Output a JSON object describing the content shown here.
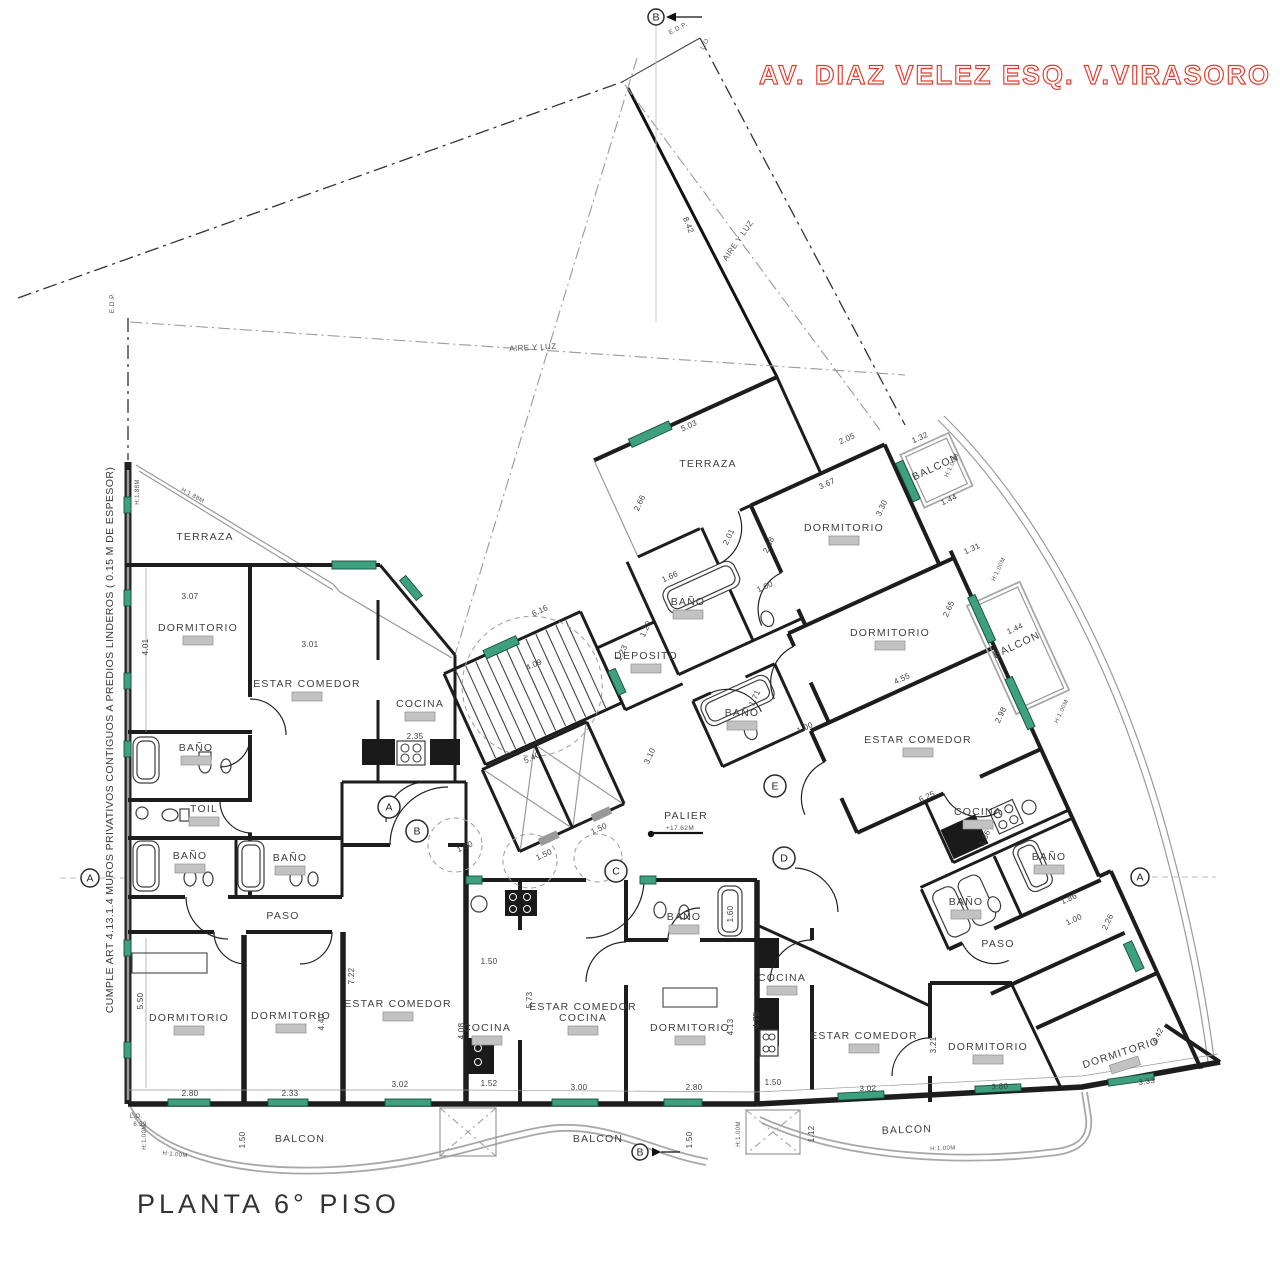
{
  "titles": {
    "street": "AV. DIAZ VELEZ ESQ. V.VIRASORO",
    "plan": "PLANTA 6° PISO",
    "compliance": "CUMPLE ART 4.13.1.4  MUROS PRIVATIVOS CONTIGUOS A PREDIOS LINDEROS ( 0.15 M DE ESPESOR)"
  },
  "colors": {
    "accent_red": "#e23b2c",
    "window_green": "#3fa080",
    "wall": "#1d1d1d",
    "gray": "#9a9a9a"
  },
  "plan": {
    "rooms": [
      {
        "t": "TERRAZA",
        "x": 205,
        "y": 540
      },
      {
        "t": "DORMITORIO",
        "x": 198,
        "y": 631,
        "tag": 1
      },
      {
        "t": "ESTAR COMEDOR",
        "x": 307,
        "y": 687,
        "tag": 1
      },
      {
        "t": "COCINA",
        "x": 420,
        "y": 707,
        "tag": 1
      },
      {
        "t": "BAÑO",
        "x": 196,
        "y": 751,
        "tag": 1
      },
      {
        "t": "TOIL",
        "x": 204,
        "y": 812,
        "tag": 1
      },
      {
        "t": "BAÑO",
        "x": 190,
        "y": 859,
        "tag": 1
      },
      {
        "t": "BAÑO",
        "x": 290,
        "y": 861,
        "tag": 1
      },
      {
        "t": "PASO",
        "x": 283,
        "y": 919
      },
      {
        "t": "DORMITORIO",
        "x": 189,
        "y": 1021,
        "tag": 1
      },
      {
        "t": "DORMITORIO",
        "x": 291,
        "y": 1019,
        "tag": 1
      },
      {
        "t": "ESTAR COMEDOR",
        "x": 398,
        "y": 1007,
        "tag": 1
      },
      {
        "t": "COCINA",
        "x": 487,
        "y": 1031,
        "tag": 1
      },
      {
        "t": "ESTAR COMEDOR|COCINA",
        "x": 583,
        "y": 1010,
        "tag": 1
      },
      {
        "t": "BAÑO",
        "x": 684,
        "y": 920,
        "tag": 1
      },
      {
        "t": "DORMITORIO",
        "x": 690,
        "y": 1031,
        "tag": 1
      },
      {
        "t": "COCINA",
        "x": 782,
        "y": 981,
        "tag": 1
      },
      {
        "t": "ESTAR COMEDOR",
        "x": 864,
        "y": 1039,
        "tag": 1
      },
      {
        "t": "DORMITORIO",
        "x": 988,
        "y": 1050,
        "tag": 1
      },
      {
        "t": "DORMITORIO",
        "x": 1122,
        "y": 1056,
        "r": -18,
        "tag": 1
      },
      {
        "t": "PASO",
        "x": 998,
        "y": 947
      },
      {
        "t": "BAÑO",
        "x": 966,
        "y": 905,
        "tag": 1
      },
      {
        "t": "BAÑO",
        "x": 1049,
        "y": 860,
        "tag": 1
      },
      {
        "t": "BAÑO",
        "x": 688,
        "y": 605,
        "tag": 1
      },
      {
        "t": "BAÑO",
        "x": 742,
        "y": 716,
        "tag": 1
      },
      {
        "t": "DEPOSITO",
        "x": 646,
        "y": 659,
        "tag": 1
      },
      {
        "t": "PALIER",
        "x": 686,
        "y": 819
      },
      {
        "t": "DORMITORIO",
        "x": 844,
        "y": 531,
        "tag": 1
      },
      {
        "t": "DORMITORIO",
        "x": 890,
        "y": 636,
        "tag": 1
      },
      {
        "t": "ESTAR COMEDOR",
        "x": 918,
        "y": 743,
        "tag": 1
      },
      {
        "t": "COCINA",
        "x": 978,
        "y": 815,
        "tag": 1
      },
      {
        "t": "TERRAZA",
        "x": 708,
        "y": 467
      },
      {
        "t": "BALCON",
        "x": 937,
        "y": 470,
        "r": -25
      },
      {
        "t": "BALCON",
        "x": 1018,
        "y": 648,
        "r": -25
      },
      {
        "t": "BALCON",
        "x": 300,
        "y": 1142
      },
      {
        "t": "BALCON",
        "x": 598,
        "y": 1142
      },
      {
        "t": "BALCON",
        "x": 907,
        "y": 1133,
        "r": -2
      }
    ],
    "dims": [
      [
        "3.07",
        190,
        599,
        0
      ],
      [
        "4.01",
        148,
        647,
        -90
      ],
      [
        "3.01",
        310,
        647,
        0
      ],
      [
        "2.35",
        415,
        739,
        0
      ],
      [
        "5.50",
        143,
        1001,
        -90
      ],
      [
        "2.80",
        190,
        1096,
        0
      ],
      [
        "2.33",
        290,
        1096,
        0
      ],
      [
        "4.40",
        324,
        1022,
        -90
      ],
      [
        "7.22",
        354,
        976,
        -90
      ],
      [
        "3.02",
        400,
        1087,
        0
      ],
      [
        "1.52",
        489,
        1086,
        0
      ],
      [
        "4.08",
        464,
        1031,
        -90
      ],
      [
        "5.73",
        532,
        1000,
        -90
      ],
      [
        "1.50",
        489,
        964,
        0
      ],
      [
        "3.00",
        579,
        1090,
        0
      ],
      [
        "2.80",
        694,
        1090,
        0
      ],
      [
        "4.13",
        733,
        1027,
        -90
      ],
      [
        "4.75",
        759,
        1020,
        -90
      ],
      [
        "1.60",
        733,
        914,
        -90
      ],
      [
        "1.50",
        773,
        1085,
        0
      ],
      [
        "3.02",
        868,
        1091,
        -2
      ],
      [
        "3.80",
        1000,
        1089,
        -3
      ],
      [
        "3.33",
        1147,
        1084,
        -8
      ],
      [
        "3.21",
        936,
        1045,
        -90
      ],
      [
        "1.12",
        814,
        1134,
        -90
      ],
      [
        "1.50",
        692,
        1140,
        -90
      ],
      [
        "1.50",
        245,
        1140,
        -90
      ],
      [
        "1.86",
        1070,
        901,
        -25
      ],
      [
        "1.00",
        1075,
        922,
        -25
      ],
      [
        "2.26",
        1110,
        923,
        -65
      ],
      [
        "4.42",
        1160,
        1037,
        -65
      ],
      [
        "6.25",
        928,
        799,
        -25
      ],
      [
        "4.55",
        903,
        681,
        -25
      ],
      [
        "2.65",
        951,
        610,
        -65
      ],
      [
        "2.98",
        1003,
        716,
        -65
      ],
      [
        "1.44",
        1016,
        631,
        -25
      ],
      [
        "3.67",
        828,
        486,
        -25
      ],
      [
        "3.30",
        884,
        509,
        -65
      ],
      [
        "5.03",
        690,
        428,
        -25
      ],
      [
        "2.05",
        848,
        441,
        -25
      ],
      [
        "2.66",
        642,
        504,
        -65
      ],
      [
        "1.32",
        921,
        440,
        -25
      ],
      [
        "1.44",
        950,
        502,
        -25
      ],
      [
        "1.31",
        973,
        551,
        -25
      ],
      [
        "2.01",
        731,
        538,
        -65
      ],
      [
        "2.08",
        771,
        546,
        -65
      ],
      [
        "1.00",
        766,
        589,
        -25
      ],
      [
        "1.66",
        671,
        579,
        -25
      ],
      [
        "1.23",
        624,
        654,
        -65
      ],
      [
        "1.20",
        648,
        630,
        -65
      ],
      [
        "3.10",
        652,
        757,
        -65
      ],
      [
        "6.16",
        541,
        613,
        -25
      ],
      [
        "4.09",
        535,
        667,
        -25
      ],
      [
        "5.40",
        533,
        760,
        -25
      ],
      [
        "1.50",
        466,
        849,
        -25
      ],
      [
        "1.50",
        545,
        857,
        -25
      ],
      [
        "1.50",
        600,
        831,
        -25
      ],
      [
        "8.42",
        686,
        226,
        68
      ],
      [
        "1.36",
        987,
        839,
        -65
      ],
      [
        "1.71",
        757,
        699,
        -65
      ],
      [
        "1.00",
        806,
        730,
        -25
      ]
    ],
    "site_labels": [
      {
        "t": "AIRE Y LUZ",
        "x": 533,
        "y": 350,
        "r": -3,
        "s": 8
      },
      {
        "t": "AIRE Y LUZ",
        "x": 740,
        "y": 242,
        "r": -55,
        "s": 8
      },
      {
        "t": "E.D.P.",
        "x": 679,
        "y": 30,
        "r": -28,
        "s": 6.5
      },
      {
        "t": "L.O.",
        "x": 707,
        "y": 44,
        "r": -62,
        "s": 6.5
      },
      {
        "t": "E.D.P.",
        "x": 114,
        "y": 303,
        "r": -90,
        "s": 6.5
      },
      {
        "t": "L.O.",
        "x": 136,
        "y": 1118,
        "r": 0,
        "s": 6
      },
      {
        "t": "6.39",
        "x": 140,
        "y": 1126,
        "r": 0,
        "s": 6
      },
      {
        "t": "H:1.00M",
        "x": 146,
        "y": 1137,
        "r": -90,
        "s": 6
      },
      {
        "t": "H:1.00M",
        "x": 740,
        "y": 1134,
        "r": -90,
        "s": 6
      },
      {
        "t": "H:1.00M",
        "x": 943,
        "y": 1150,
        "r": -3,
        "s": 6
      },
      {
        "t": "H:1.00M",
        "x": 175,
        "y": 1156,
        "r": 6,
        "s": 6
      },
      {
        "t": "H:1.00M",
        "x": 953,
        "y": 466,
        "r": -65,
        "s": 6
      },
      {
        "t": "H:1.00M",
        "x": 1000,
        "y": 570,
        "r": -65,
        "s": 6
      },
      {
        "t": "H:1.00M",
        "x": 1063,
        "y": 712,
        "r": -65,
        "s": 6
      },
      {
        "t": "H:1.88M",
        "x": 139,
        "y": 492,
        "r": -90,
        "s": 6
      },
      {
        "t": "H:1.88M",
        "x": 192,
        "y": 497,
        "r": 29,
        "s": 6
      },
      {
        "t": "+17.62M",
        "x": 680,
        "y": 830,
        "r": 0,
        "s": 6.5
      }
    ],
    "markers": [
      {
        "l": "B",
        "x": 656,
        "y": 17,
        "rad": 8,
        "arrow": "left"
      },
      {
        "l": "A",
        "x": 389,
        "y": 807,
        "rad": 11
      },
      {
        "l": "B",
        "x": 417,
        "y": 831,
        "rad": 11
      },
      {
        "l": "C",
        "x": 616,
        "y": 871,
        "rad": 11
      },
      {
        "l": "E",
        "x": 775,
        "y": 786,
        "rad": 11
      },
      {
        "l": "D",
        "x": 784,
        "y": 858,
        "rad": 11
      },
      {
        "l": "A",
        "x": 1140,
        "y": 877,
        "rad": 9
      },
      {
        "l": "A",
        "x": 90,
        "y": 878,
        "rad": 9
      },
      {
        "l": "B",
        "x": 640,
        "y": 1152,
        "rad": 8,
        "arrow": "right"
      }
    ]
  }
}
